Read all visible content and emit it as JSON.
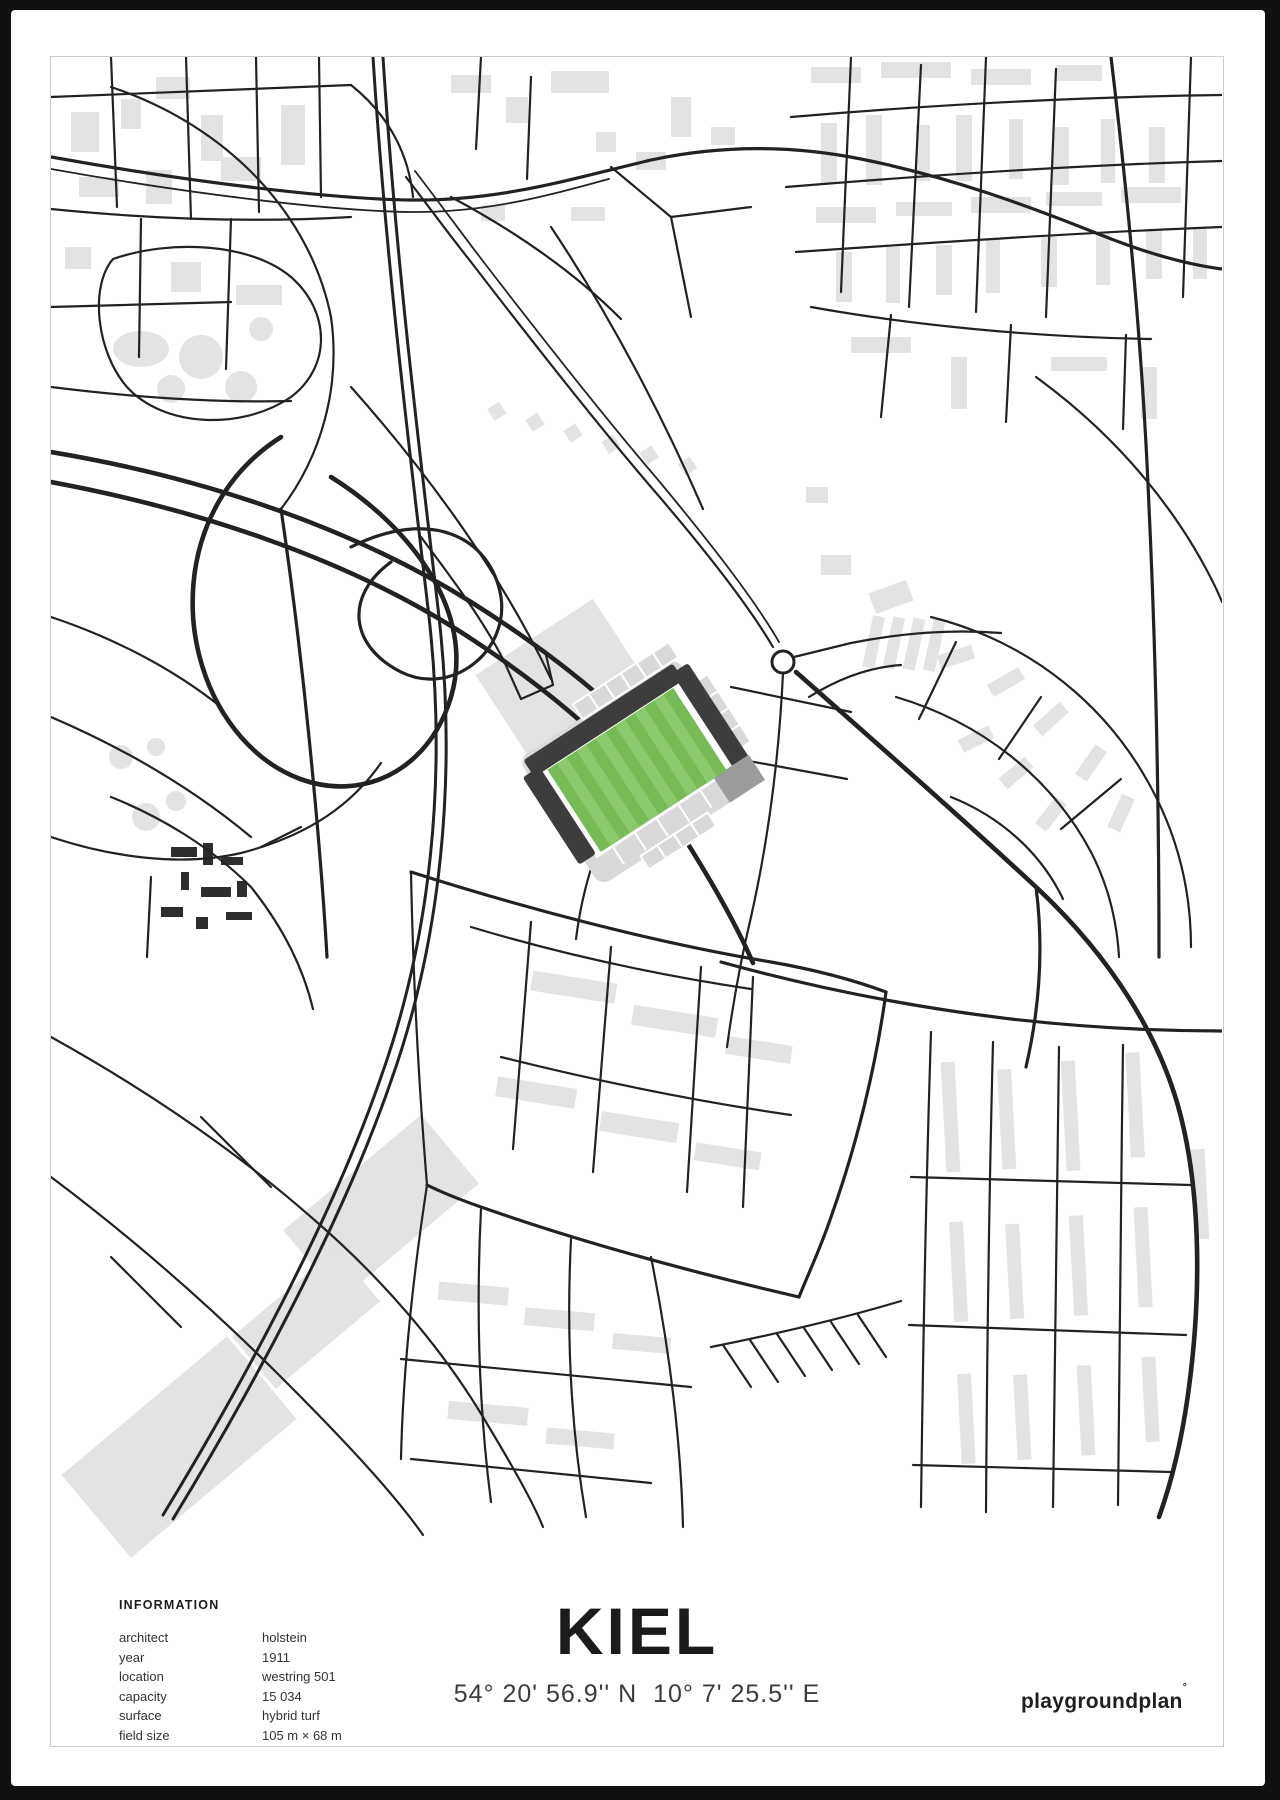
{
  "poster": {
    "title": "KIEL",
    "coordinates": "54° 20' 56.9'' N  10° 7' 25.5'' E",
    "brand": "playgroundplan",
    "brand_mark": "°"
  },
  "information": {
    "heading": "INFORMATION",
    "rows": [
      {
        "label": "architect",
        "value": "holstein"
      },
      {
        "label": "year",
        "value": "1911"
      },
      {
        "label": "location",
        "value": "westring 501"
      },
      {
        "label": "capacity",
        "value": "15 034"
      },
      {
        "label": "surface",
        "value": "hybrid turf"
      },
      {
        "label": "field size",
        "value": "105 m × 68 m"
      }
    ]
  },
  "map": {
    "colors": {
      "street": "#222222",
      "building": "#e3e3e3",
      "pitch": "#76bb55",
      "pitch_stripe": "#8ac96c",
      "stand_dark": "#3d3d3d",
      "stand_light": "#d9d9d9",
      "stand_mid": "#9c9c9c",
      "frame": "#cccccc"
    }
  }
}
